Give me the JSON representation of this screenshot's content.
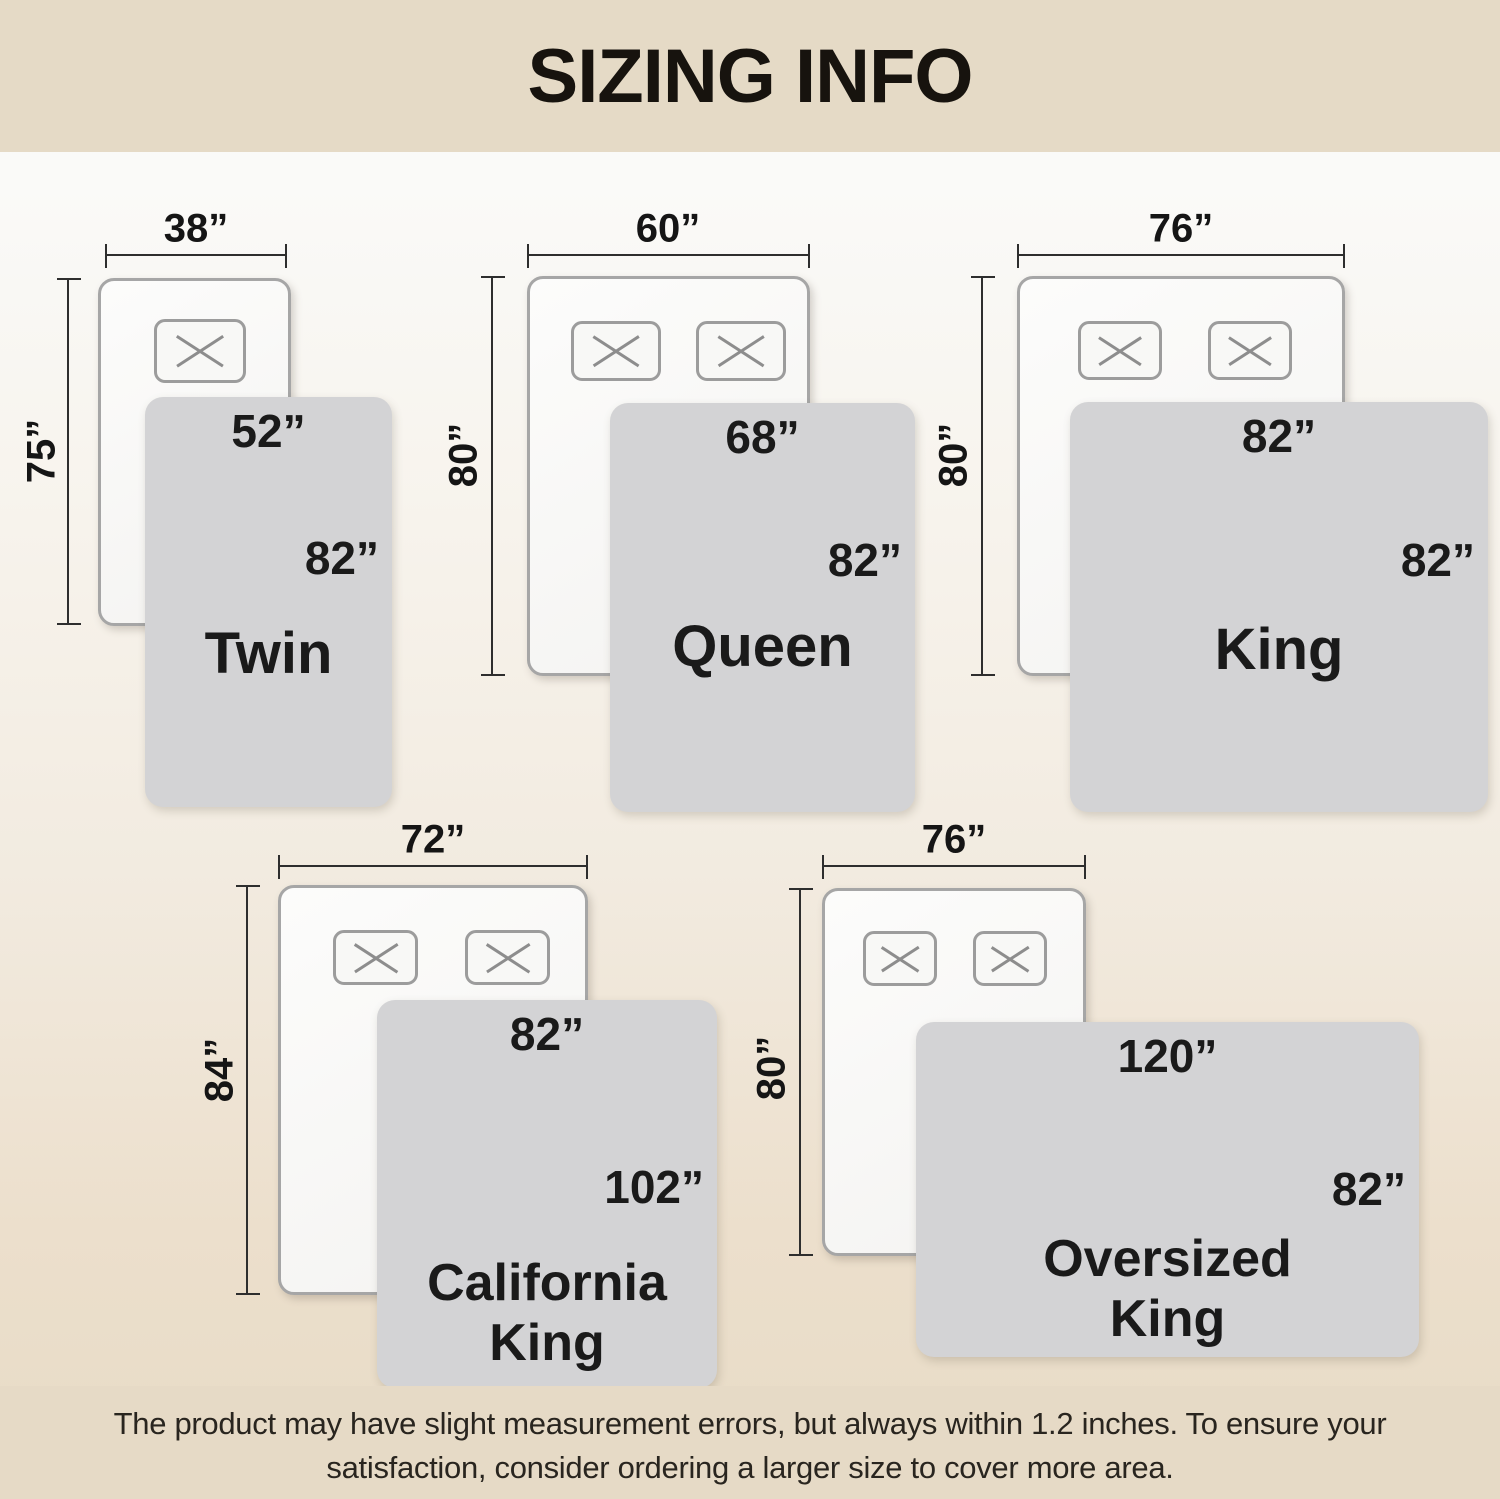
{
  "header": {
    "title": "SIZING INFO"
  },
  "footer": {
    "line1": "The product may have slight measurement errors, but always within 1.2 inches. To ensure your",
    "line2": "satisfaction, consider ordering a larger size to cover more area."
  },
  "colors": {
    "header_bg": "#e5dac6",
    "footer_bg": "#e6dac6",
    "background_top": "#fdfdfc",
    "background_bottom": "#e7dbc6",
    "blanket_fill": "#d3d3d5",
    "bed_fill": "#f8f8f6",
    "bed_border": "#a6a6a6",
    "dimension_line": "#2e2e2e",
    "text": "#1a1a1a"
  },
  "sizes": [
    {
      "id": "twin",
      "name_line1": "Twin",
      "bed_width": "38”",
      "bed_length": "75”",
      "blanket_width": "52”",
      "blanket_length": "82”",
      "pillows": 1
    },
    {
      "id": "queen",
      "name_line1": "Queen",
      "bed_width": "60”",
      "bed_length": "80”",
      "blanket_width": "68”",
      "blanket_length": "82”",
      "pillows": 2
    },
    {
      "id": "king",
      "name_line1": "King",
      "bed_width": "76”",
      "bed_length": "80”",
      "blanket_width": "82”",
      "blanket_length": "82”",
      "pillows": 2
    },
    {
      "id": "california-king",
      "name_line1": "California",
      "name_line2": "King",
      "bed_width": "72”",
      "bed_length": "84”",
      "blanket_width": "82”",
      "blanket_length": "102”",
      "pillows": 2
    },
    {
      "id": "oversized-king",
      "name_line1": "Oversized",
      "name_line2": "King",
      "bed_width": "76”",
      "bed_length": "80”",
      "blanket_width": "120”",
      "blanket_length": "82”",
      "pillows": 2
    }
  ]
}
